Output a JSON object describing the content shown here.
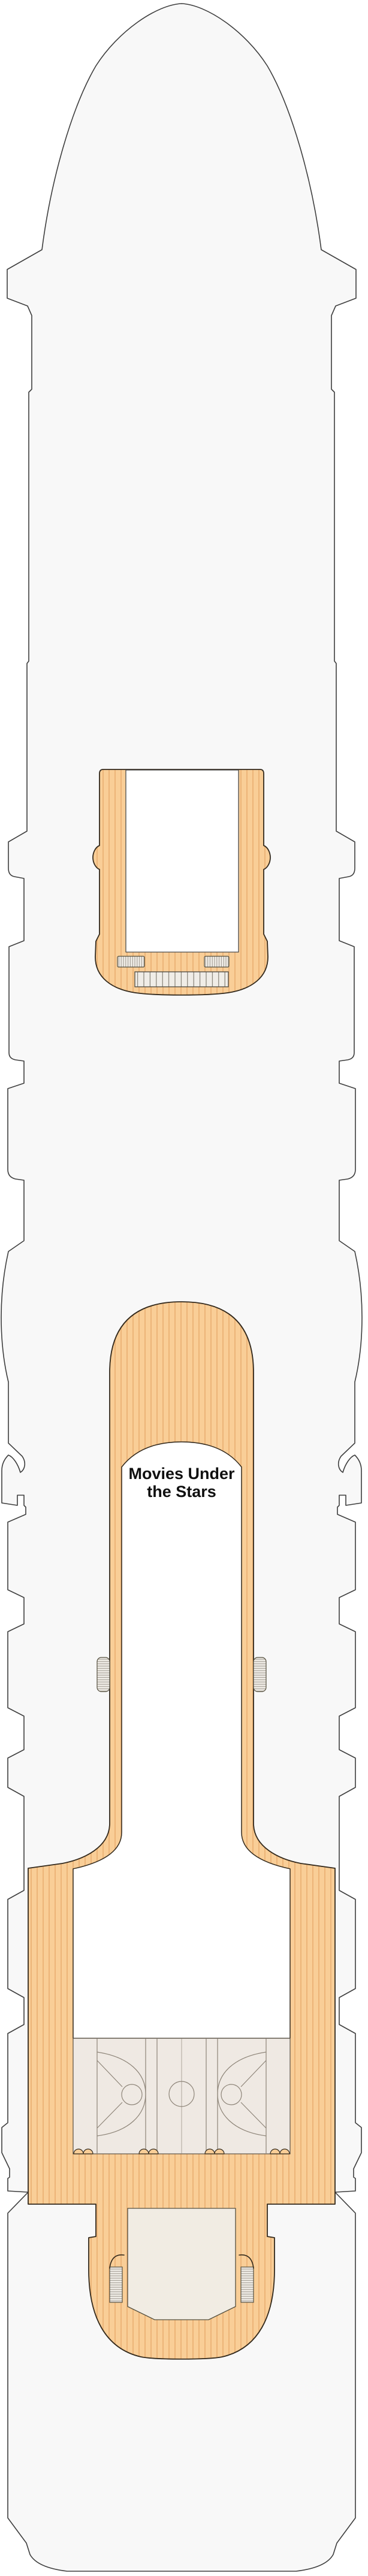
{
  "document": {
    "title": "Cruise ship deck plan - open sun deck"
  },
  "deck": {
    "muts_label": {
      "line1": "Movies Under",
      "line2": "the Stars"
    }
  },
  "symbols": {
    "ladder-icon": "hatched rounded rectangle",
    "vent-grill-icon": "vertically divided rectangle",
    "skylight-icon": "white open rectangle",
    "basketball-court-icon": "court line markings with centre circle and three-point arcs",
    "scallop-vent-icon": "paired semicircle bumps",
    "davit-notch-icon": "hooked notch on hull edge",
    "stern-terrace-icon": "U-shaped deck extension"
  },
  "colors": {
    "hull-fill": "#F8F8F8",
    "hull-line": "#3E3E3E",
    "deck-orange": "#F9CE97",
    "deck-stripe": "#E7AA6A",
    "deck-outline": "#33291C",
    "court-fill": "#EFE9E3",
    "court-line": "#8D8478",
    "panel-fill": "#F0EDE7",
    "panel-line": "#55503F",
    "panel-hatch": "#9A948A",
    "terrace-fill": "#F1ECE3",
    "interior-white": "#FFFFFF",
    "label-color": "#101010",
    "page-bg": "#FFFFFF"
  }
}
